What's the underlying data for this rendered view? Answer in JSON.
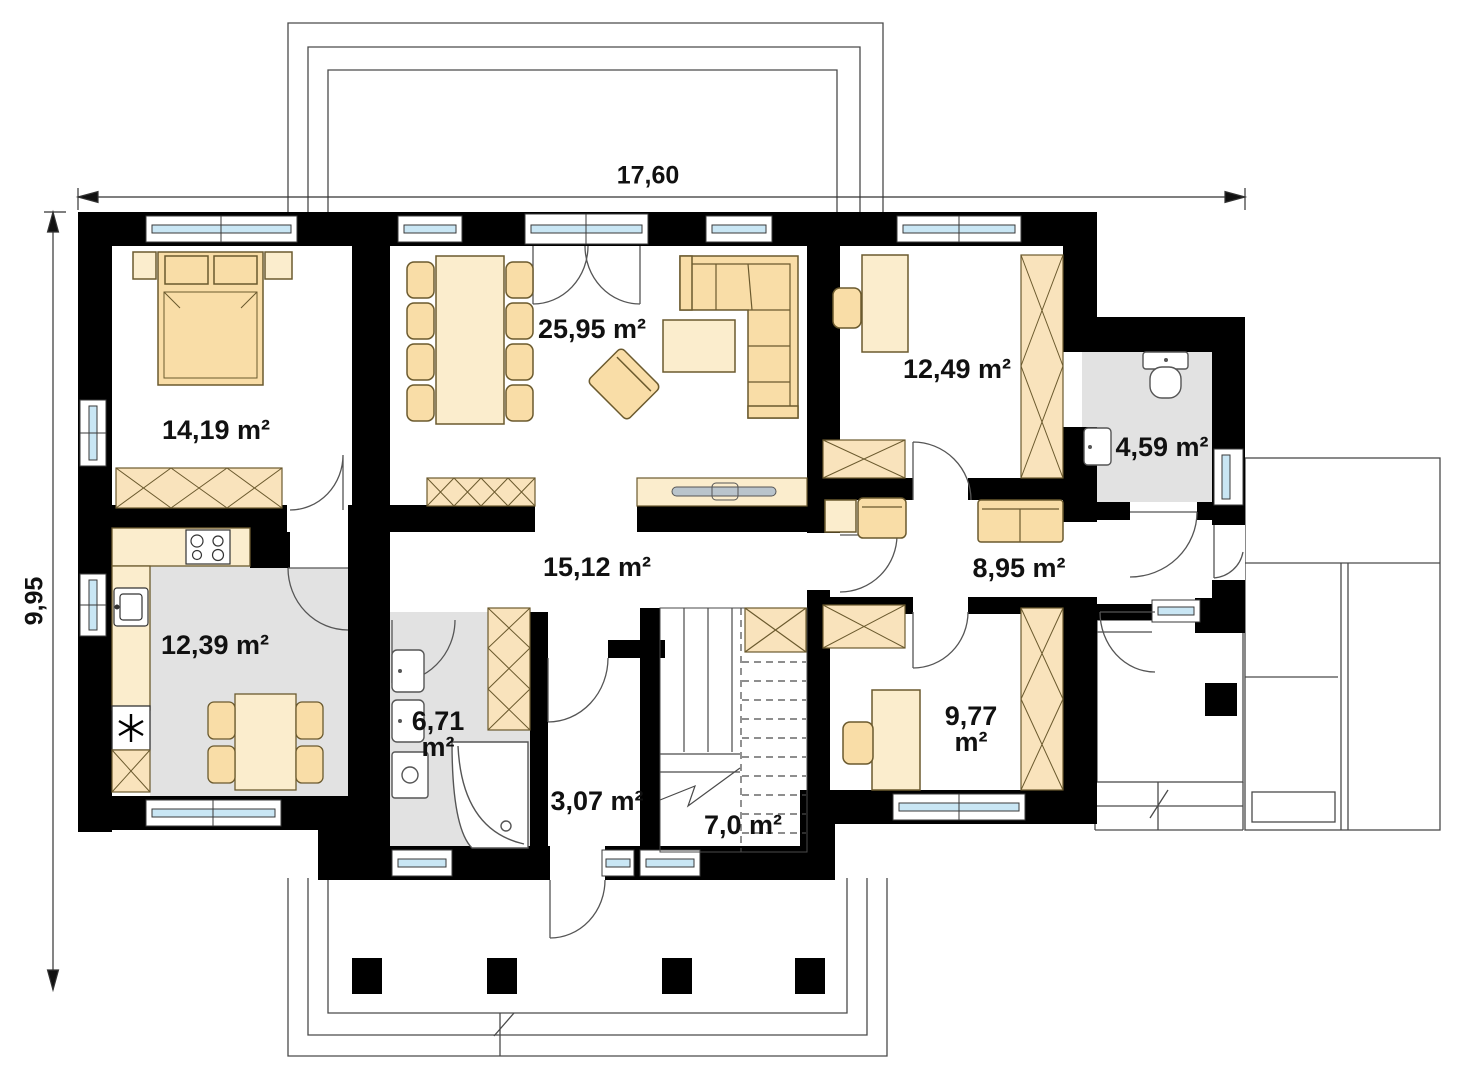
{
  "plan": {
    "dimensions": {
      "width": "17,60",
      "height": "9,95"
    },
    "rooms": [
      {
        "name": "bedroom",
        "area": "14,19 m²"
      },
      {
        "name": "living-dining",
        "area": "25,95 m²"
      },
      {
        "name": "office",
        "area": "12,49 m²"
      },
      {
        "name": "wc",
        "area": "4,59 m²"
      },
      {
        "name": "hall",
        "area": "15,12 m²"
      },
      {
        "name": "corridor",
        "area": "8,95 m²"
      },
      {
        "name": "kitchen",
        "area": "12,39 m²"
      },
      {
        "name": "bathroom",
        "area": "6,71 m²"
      },
      {
        "name": "entry",
        "area": "3,07 m²"
      },
      {
        "name": "staircase",
        "area": "7,0 m²"
      },
      {
        "name": "room",
        "area": "9,77 m²"
      }
    ],
    "colors": {
      "wall": "#000000",
      "furniture": "#F9DDA7",
      "furniture_light": "#FBEDCD",
      "glass": "#C9E6F4",
      "floor": "#E2E2E2",
      "line": "#4a4a4a"
    }
  }
}
